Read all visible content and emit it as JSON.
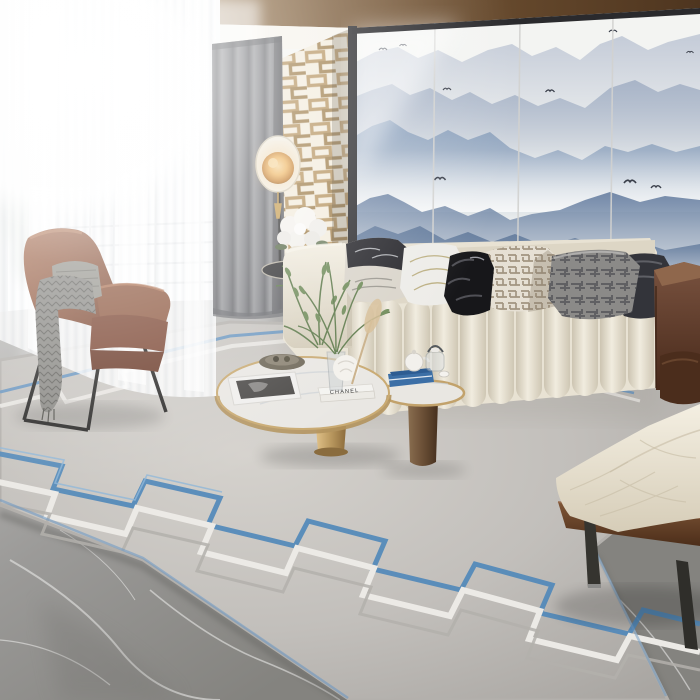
{
  "meta": {
    "title": "Modern living room with ink-wash mountain mural"
  },
  "colors": {
    "wood_ceiling": "#7a5a38",
    "mural_bg": "#f3f4f2",
    "mountain_far": "#c6cdd9",
    "mountain_mid": "#8aa0bc",
    "mountain_near": "#647c9d",
    "frame_dark": "#2c2c2f",
    "lattice_gold": "#b5935f",
    "curtain_grey": "#85868a",
    "sheer_white": "#f7f8f9",
    "lamp_glow": "#e8a050",
    "sofa_cream": "#e9e3d4",
    "leather_brown": "#6e4a36",
    "armchair_leather": "#96604a",
    "throw_grey": "#8b8a86",
    "rug_base": "#c2bfbb",
    "rug_white": "#eceae6",
    "rug_blue": "#4f87b9",
    "marble_grey": "#989795",
    "table_gold": "#c9aa72",
    "book_blue": "#3c6fa6",
    "plant_green": "#5e7a4b",
    "bench_cream": "#ece5d4",
    "bench_wood": "#6e4a30"
  },
  "objects": {
    "mural": {
      "label": "ink-wash mountain mural wall",
      "panels": 4,
      "birds": 9
    },
    "window": {
      "label": "bright window with sheer curtains"
    },
    "curtain": {
      "label": "grey linen drape"
    },
    "lattice": {
      "label": "gold lattice screen panel"
    },
    "floor_lamp": {
      "label": "disc floor lamp",
      "state": "on"
    },
    "sofa": {
      "label": "cream channel-tufted sofa",
      "pillow_count": 7
    },
    "armchair": {
      "label": "tan leather wing chair with grey throw"
    },
    "side_table": {
      "label": "side table with white hydrangeas"
    },
    "coffee_table": {
      "label": "round nesting coffee tables",
      "book_spine_text": "CHANEL"
    },
    "tea_set": {
      "label": "teapot and glass kettle"
    },
    "rug": {
      "label": "grey rug with blue greek-key border"
    },
    "floor": {
      "label": "grey marble floor"
    },
    "bench": {
      "label": "cream daybed bench with walnut frame"
    }
  }
}
